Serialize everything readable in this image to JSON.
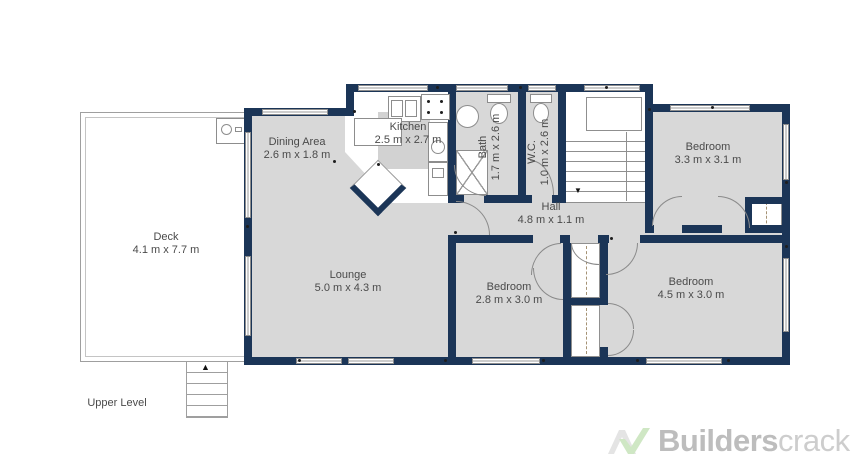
{
  "rooms": [
    {
      "name": "Deck",
      "dims": "4.1 m x 7.7 m"
    },
    {
      "name": "Dining Area",
      "dims": "2.6 m x 1.8 m"
    },
    {
      "name": "Kitchen",
      "dims": "2.5 m x 2.7 m"
    },
    {
      "name": "Bath",
      "dims": "1.7 m x 2.6 m"
    },
    {
      "name": "W.C.",
      "dims": "1.0 m x 2.6 m"
    },
    {
      "name": "Hall",
      "dims": "4.8 m x 1.1 m"
    },
    {
      "name": "Lounge",
      "dims": "5.0 m x 4.3 m"
    },
    {
      "name": "Bedroom",
      "dims": "3.3 m x 3.1 m"
    },
    {
      "name": "Bedroom",
      "dims": "2.8 m x 3.0 m"
    },
    {
      "name": "Bedroom",
      "dims": "4.5 m x 3.0 m"
    }
  ],
  "level_label": "Upper Level",
  "logo": {
    "bold": "Builders",
    "light": "crack"
  },
  "colors": {
    "wall": "#1b3557",
    "floor": "#d8d8d8",
    "kitchen_block": "#d2d2d2",
    "label_text": "#4a4a4a",
    "logo_gray": "#e4e4e4",
    "logo_green": "#cfe7c4",
    "logo_text_bold": "#bdbdbd",
    "logo_text_light": "#cdcdcd"
  }
}
